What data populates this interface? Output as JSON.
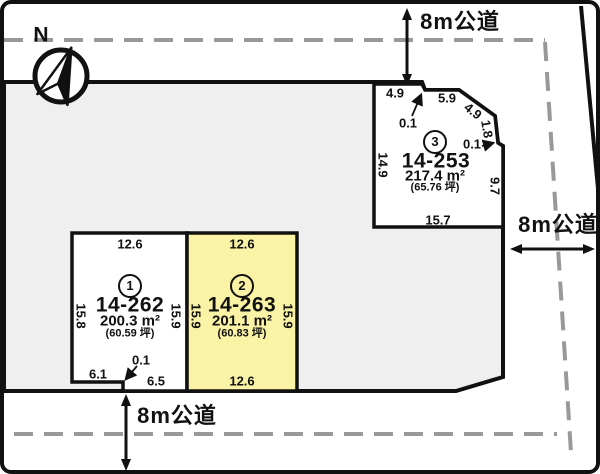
{
  "compass": {
    "north": "N"
  },
  "roads": {
    "top": "8m公道",
    "right": "8m公道",
    "bottom": "8m公道"
  },
  "plots": {
    "p1": {
      "num": "1",
      "code": "14-262",
      "area": "200.3 m²",
      "tsubo": "(60.59 坪)",
      "dim_top": "12.6",
      "dim_left": "15.8",
      "dim_right": "15.9",
      "dim_step": "0.1",
      "dim_bottom_left": "6.1",
      "dim_bottom_right": "6.5"
    },
    "p2": {
      "num": "2",
      "code": "14-263",
      "area": "201.1 m²",
      "tsubo": "(60.83 坪)",
      "dim_top": "12.6",
      "dim_left": "15.9",
      "dim_right": "15.9",
      "dim_bottom": "12.6"
    },
    "p3": {
      "num": "3",
      "code": "14-253",
      "area": "217.4 m²",
      "tsubo": "(65.76 坪)",
      "dim_top1": "4.9",
      "dim_step_top": "0.1",
      "dim_top2": "5.9",
      "dim_diag": "4.9",
      "dim_right1": "1.8",
      "dim_step_right": "0.1",
      "dim_right2": "9.7",
      "dim_bottom": "15.7",
      "dim_left": "14.9"
    }
  },
  "colors": {
    "highlight": "#FAF3A5",
    "site_fill": "#EFEFEF",
    "dash": "#999999",
    "line": "#111111"
  }
}
